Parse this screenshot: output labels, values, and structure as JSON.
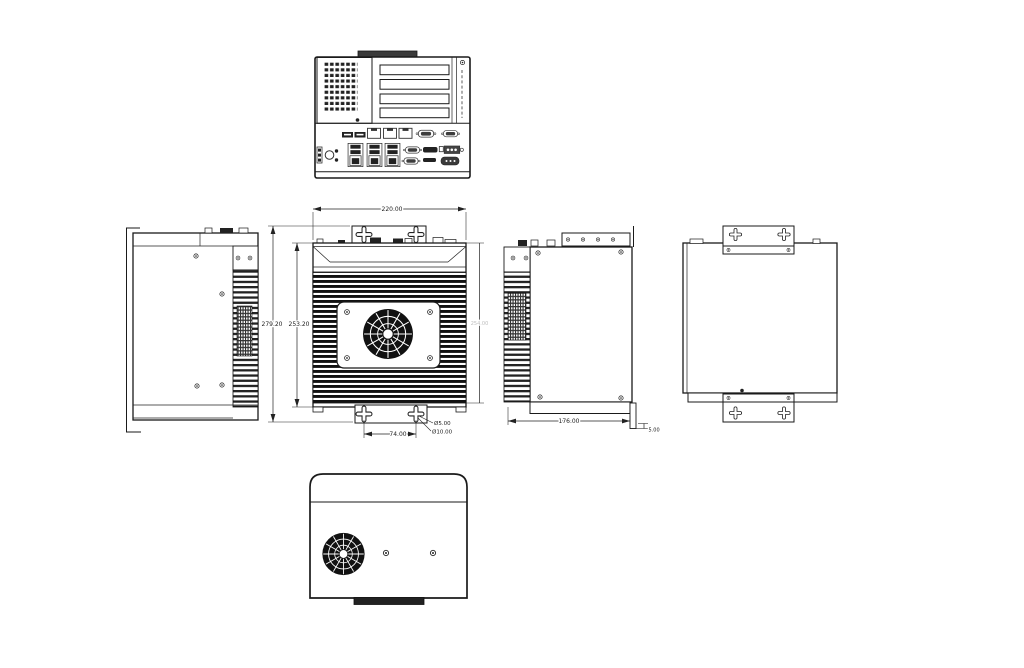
{
  "page": {
    "background": "#ffffff",
    "line_color": "#1a1a1a"
  },
  "drawing": {
    "kind": "mechanical-dimension-drawing",
    "views": {
      "front": "front-panel-view",
      "top": "top-view-heatsink-fan",
      "left": "left-side-view",
      "right": "right-side-view",
      "rear": "rear-mounting-view",
      "bottom": "bottom-view-fan"
    },
    "dimensions": {
      "top_width": "220.00",
      "overall_height": "279.20",
      "body_height": "253.20",
      "mount_hole_spacing": "74.00",
      "keyhole_small_dia": "Ø5.00",
      "keyhole_large_dia": "Ø10.00",
      "side_depth": "176.00",
      "bracket_thickness": "5.00",
      "right_side_height_faint": "254.00"
    }
  }
}
